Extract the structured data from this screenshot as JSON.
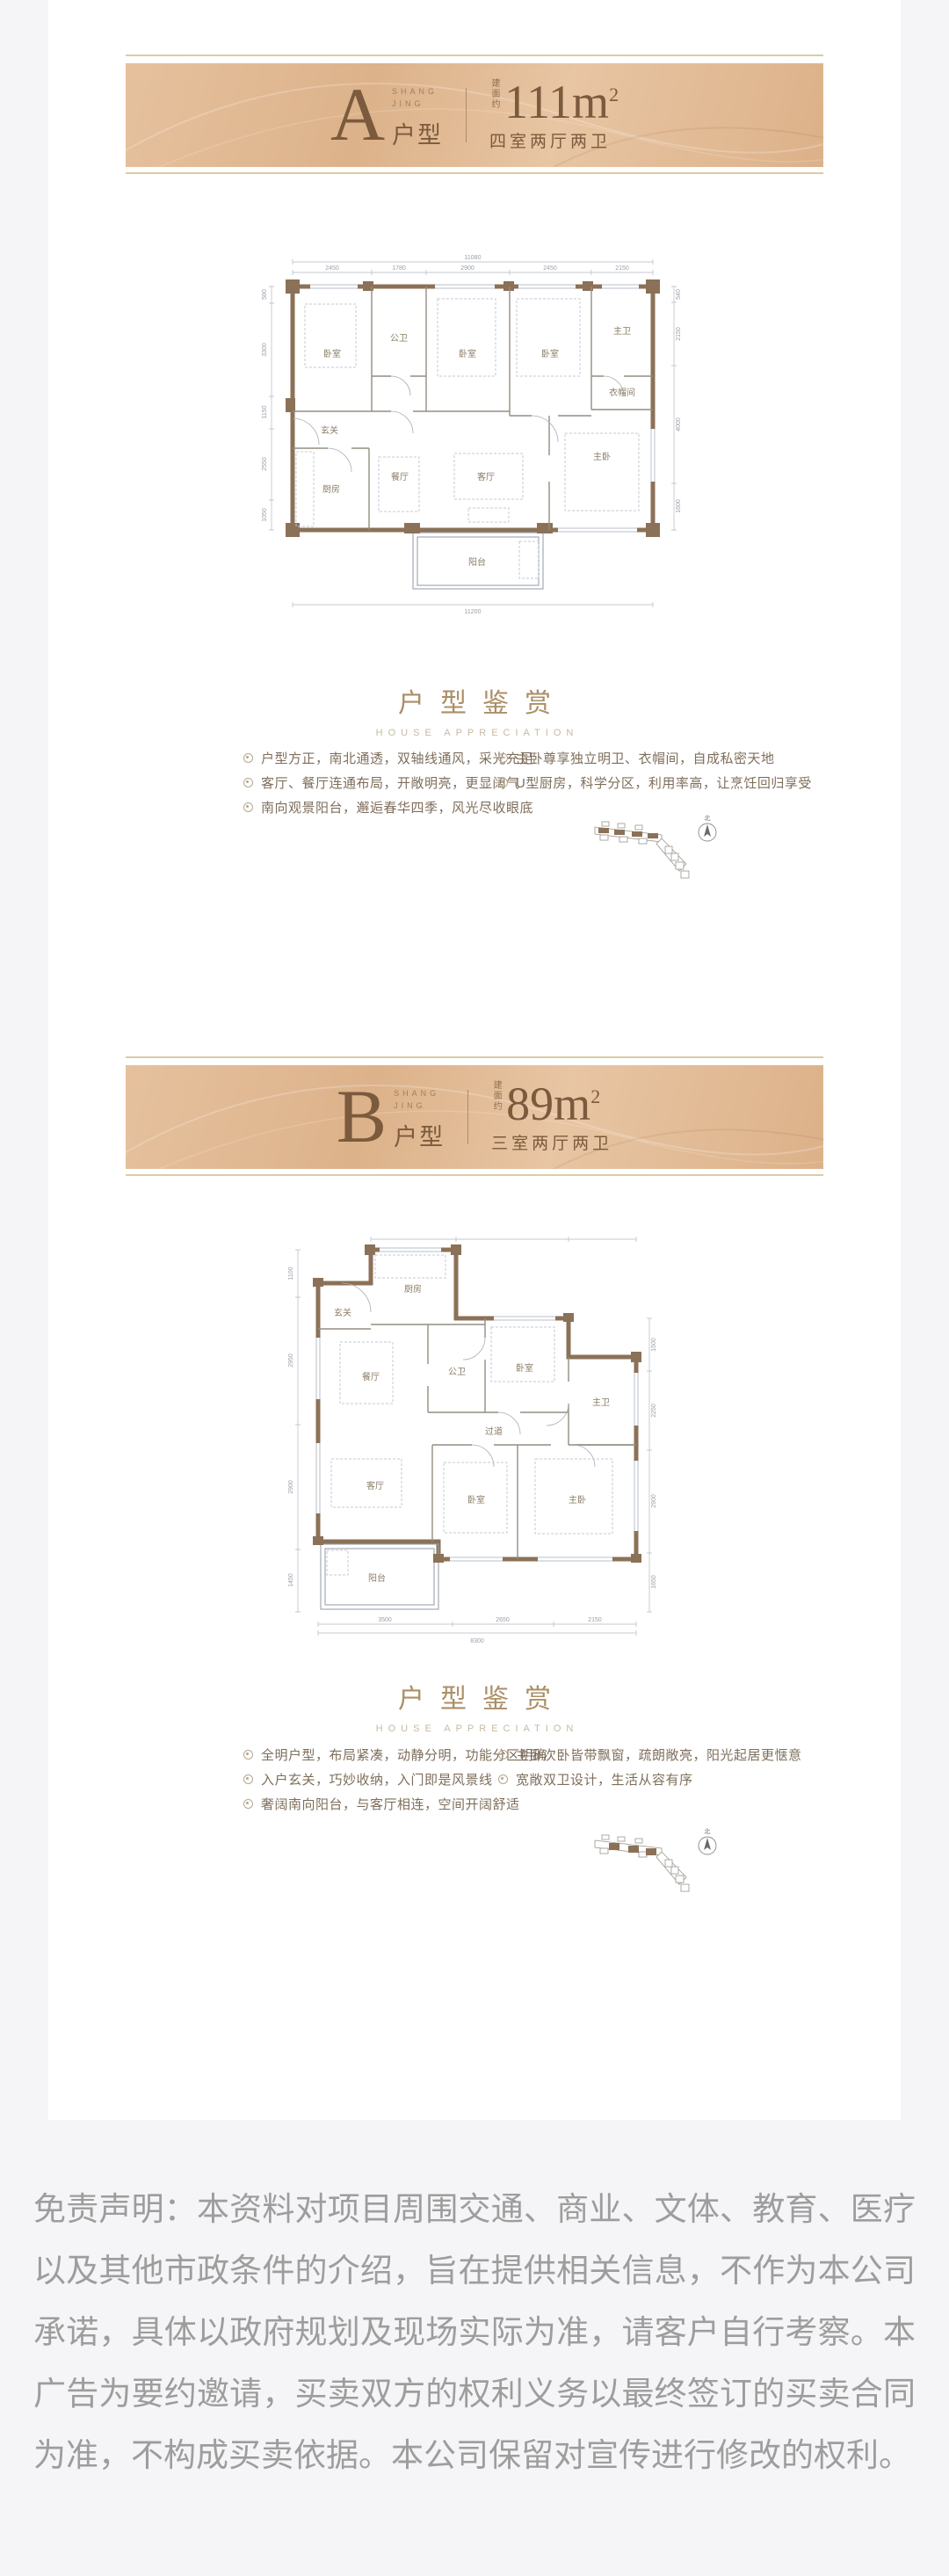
{
  "page": {
    "background": "#f5f5f7",
    "card_background": "#ffffff",
    "banner_tan": "#dfb691",
    "text_brown": "#7b5a3d",
    "rule_khaki": "#d9cda6",
    "wall_brown": "#8b7157",
    "disclaimer_gray": "#9d9d9d"
  },
  "sections": [
    {
      "banner": {
        "letter": "A",
        "brand": "SHANG\nJING",
        "suffix": "户型",
        "area_prefix": "建面约",
        "area_value": "111",
        "area_unit": "m",
        "area_sup": "2",
        "layout": "四室两厅两卫"
      },
      "floorplan": {
        "rooms": [
          "卧室",
          "公卫",
          "卧室",
          "卧室",
          "主卫",
          "衣帽间",
          "玄关",
          "厨房",
          "餐厅",
          "客厅",
          "主卧",
          "阳台"
        ],
        "dims_top": [
          "2450",
          "1780",
          "2900",
          "2450",
          "2150"
        ],
        "dim_top_total": "11080",
        "dim_bottom_total": "11200",
        "dims_left": [
          "580",
          "3300",
          "1150",
          "2550",
          "1050"
        ],
        "dims_right": [
          "540",
          "2150",
          "4000",
          "1600"
        ]
      },
      "appreciation": {
        "title": "户型鉴赏",
        "subtitle": "HOUSE APPRECIATION",
        "bullets_left": [
          "户型方正，南北通透，双轴线通风，采光充足",
          "客厅、餐厅连通布局，开敞明亮，更显阔气",
          "南向观景阳台，邂逅春华四季，风光尽收眼底"
        ],
        "bullets_right": [
          "主卧尊享独立明卫、衣帽间，自成私密天地",
          "U型厨房，科学分区，利用率高，让烹饪回归享受"
        ]
      },
      "keyplan": {
        "compass": "北"
      }
    },
    {
      "banner": {
        "letter": "B",
        "brand": "SHANG\nJING",
        "suffix": "户型",
        "area_prefix": "建面约",
        "area_value": "89",
        "area_unit": "m",
        "area_sup": "2",
        "layout": "三室两厅两卫"
      },
      "floorplan": {
        "rooms": [
          "厨房",
          "玄关",
          "餐厅",
          "公卫",
          "卧室",
          "主卫",
          "过道",
          "客厅",
          "卧室",
          "主卧",
          "阳台"
        ],
        "dims_bottom": [
          "3500",
          "2650",
          "2150"
        ],
        "dim_bottom_total": "8300",
        "dims_left": [
          "1100",
          "2950",
          "2900",
          "1450"
        ],
        "dims_right": [
          "1500",
          "2250",
          "2900",
          "1650"
        ]
      },
      "appreciation": {
        "title": "户型鉴赏",
        "subtitle": "HOUSE APPRECIATION",
        "bullets_left": [
          "全明户型，布局紧凑，动静分明，功能分区明确",
          "入户玄关，巧妙收纳，入门即是风景线",
          "奢阔南向阳台，与客厅相连，空间开阔舒适"
        ],
        "bullets_right": [
          "主卧次卧皆带飘窗，疏朗敞亮，阳光起居更惬意",
          "宽敞双卫设计，生活从容有序"
        ]
      },
      "keyplan": {
        "compass": "北"
      }
    }
  ],
  "disclaimer": "免责声明：本资料对项目周围交通、商业、文体、教育、医疗以及其他市政条件的介绍，旨在提供相关信息，不作为本公司承诺，具体以政府规划及现场实际为准，请客户自行考察。本广告为要约邀请，买卖双方的权利义务以最终签订的买卖合同为准，不构成买卖依据。本公司保留对宣传进行修改的权利。"
}
